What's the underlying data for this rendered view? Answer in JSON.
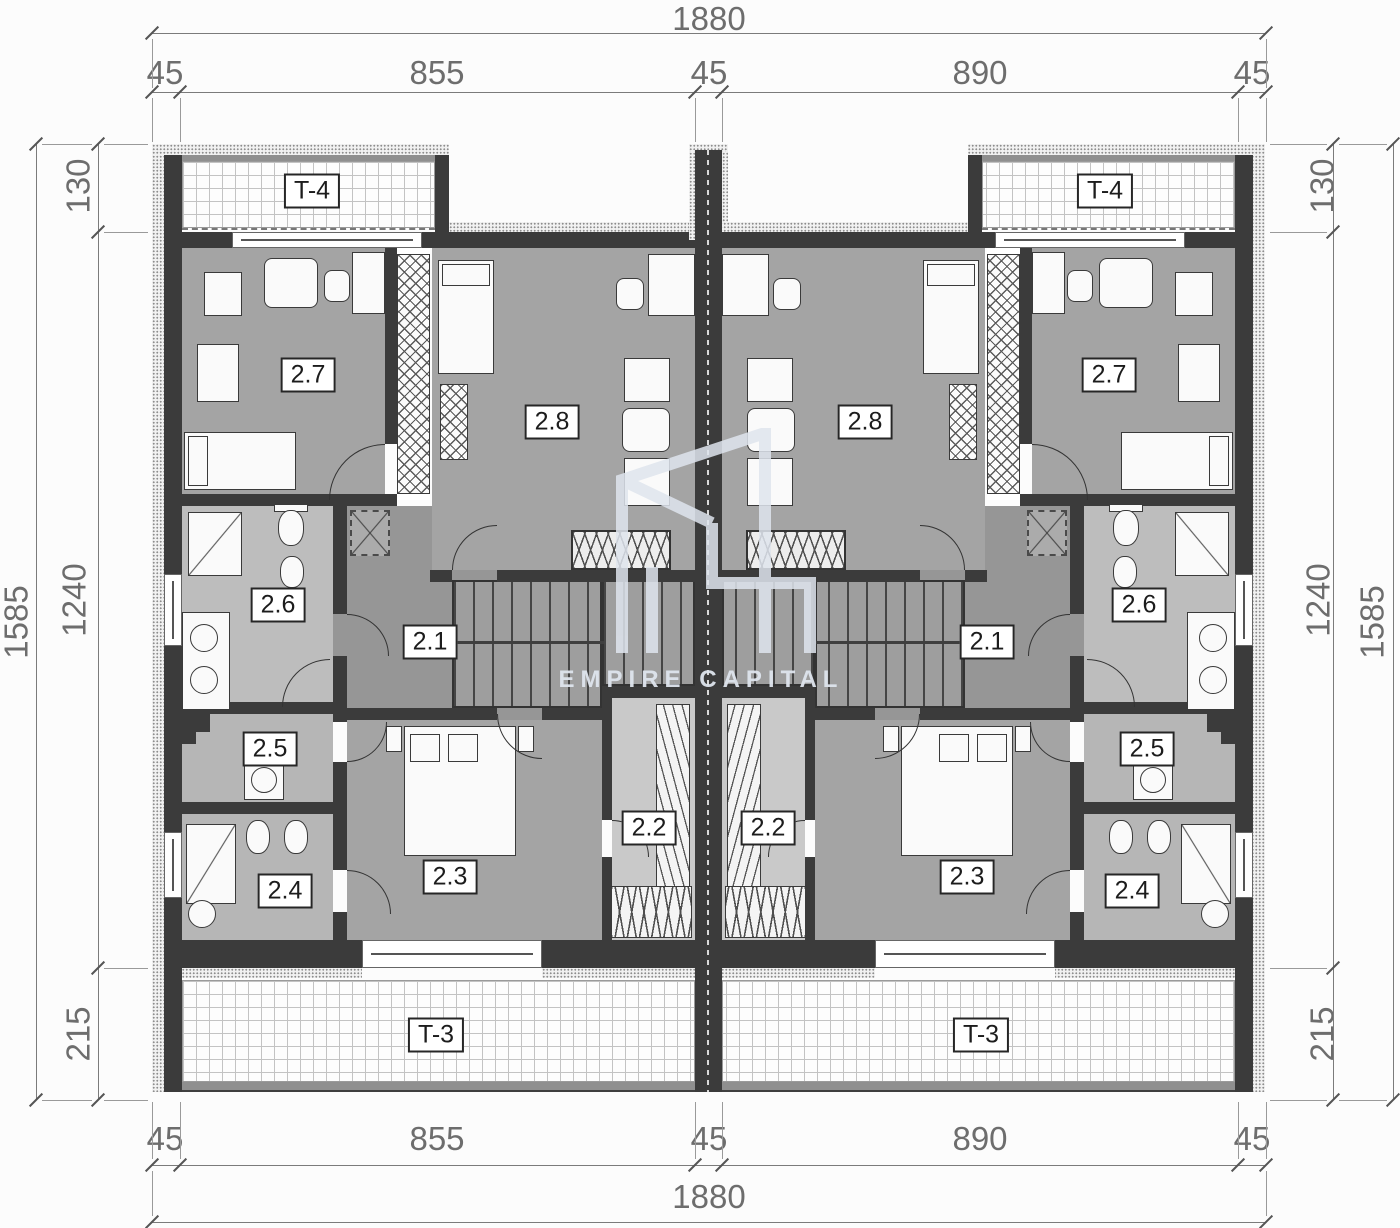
{
  "watermark": {
    "brand": "EMPIRE CAPITAL"
  },
  "plan": {
    "rooms": {
      "r21": "2.1",
      "r22": "2.2",
      "r23": "2.3",
      "r24": "2.4",
      "r25": "2.5",
      "r26": "2.6",
      "r27": "2.7",
      "r28": "2.8"
    },
    "terraces": {
      "upper": "T-4",
      "lower": "T-3"
    }
  },
  "dimensions": {
    "horizontal": {
      "total": "1880",
      "segments": [
        "45",
        "855",
        "45",
        "890",
        "45"
      ]
    },
    "vertical": {
      "total": "1585",
      "segments": [
        "130",
        "1240",
        "215"
      ]
    }
  },
  "colors": {
    "bg": "#fcfcfc",
    "wall": "#3b3b3b",
    "floor": "#a4a4a4",
    "floor-dark": "#969696",
    "floor-light": "#bdbdbd",
    "floor-lighter": "#c9c9c9",
    "terrace-line": "#c3c3c3",
    "hatch": "#8d8d8d",
    "dim": "#6d6d6d",
    "label": "#1c1c1c",
    "watermark": "#dfe5ee"
  }
}
